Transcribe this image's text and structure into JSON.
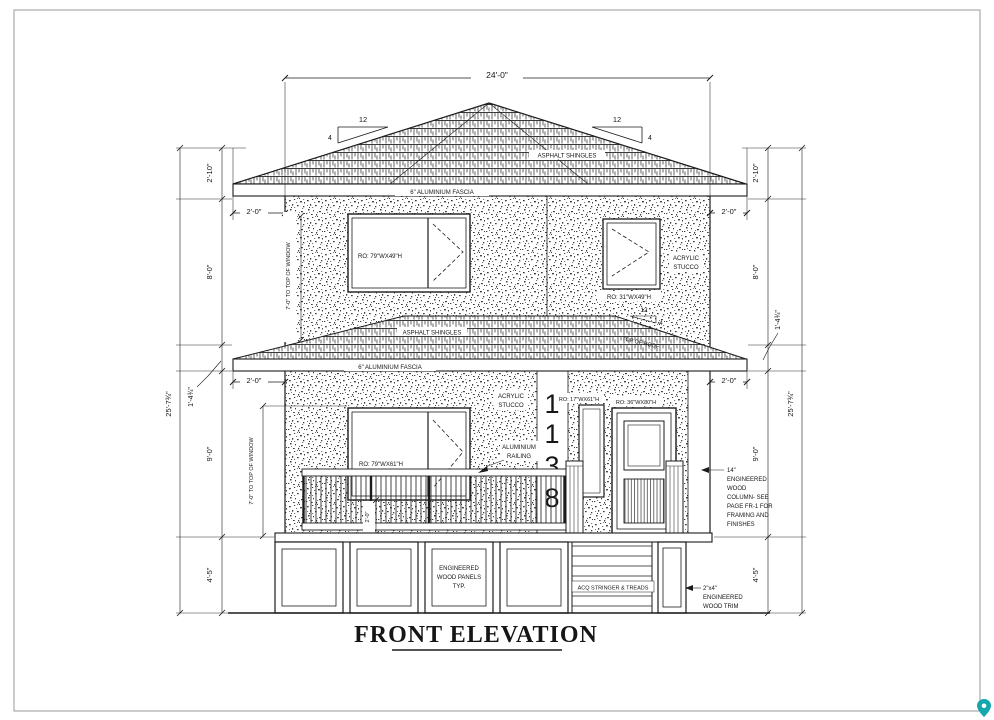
{
  "title": "FRONT ELEVATION",
  "address": {
    "digits": [
      "1",
      "1",
      "3",
      "8"
    ]
  },
  "dims": {
    "total_width": "24'-0\"",
    "total_height": "25'-7¾\"",
    "roof_height": "2'-10\"",
    "upper_floor": "8'-0\"",
    "main_floor": "9'-0\"",
    "foundation": "4'-5\"",
    "roof_band": "1'-4¾\"",
    "overhang": "2'-0\"",
    "sill_height": "2'-0\"",
    "window_head": "7'-0\" TO TOP OF WINDOW"
  },
  "roof": {
    "material": "ASPHALT SHINGLES",
    "fascia": "6\" ALUMINIUM FASCIA",
    "slope_run": "12",
    "slope_rise": "4",
    "lower_top_note": "TOP OF ROOF"
  },
  "walls": {
    "stucco_lines": [
      "ACRYLIC",
      "STUCCO"
    ]
  },
  "windows": {
    "upper_left": "RO: 79\"WX49\"H",
    "upper_right": "RO: 31\"WX49\"H",
    "main": "RO: 79\"WX61\"H",
    "sidelight": "RO: 17\"WX61\"H",
    "door": "RO: 36\"WX80\"H"
  },
  "notes": {
    "railing": [
      "ALUMINIUM",
      "RAILING"
    ],
    "column": [
      "14\"",
      "ENGINEERED",
      "WOOD",
      "COLUMN- SEE",
      "PAGE FR-1 FOR",
      "FRAMING AND",
      "FINISHES"
    ],
    "panels": [
      "ENGINEERED",
      "WOOD PANELS",
      "TYP."
    ],
    "stairs": "ACQ STRINGER & TREADS",
    "trim": [
      "2\"x4\"",
      "ENGINEERED",
      "WOOD TRIM"
    ]
  },
  "icons": {
    "watermark": "location-pin",
    "watermark_color": "#14a7ad"
  },
  "colors": {
    "ink": "#1b1b1b",
    "paper": "#ffffff"
  }
}
